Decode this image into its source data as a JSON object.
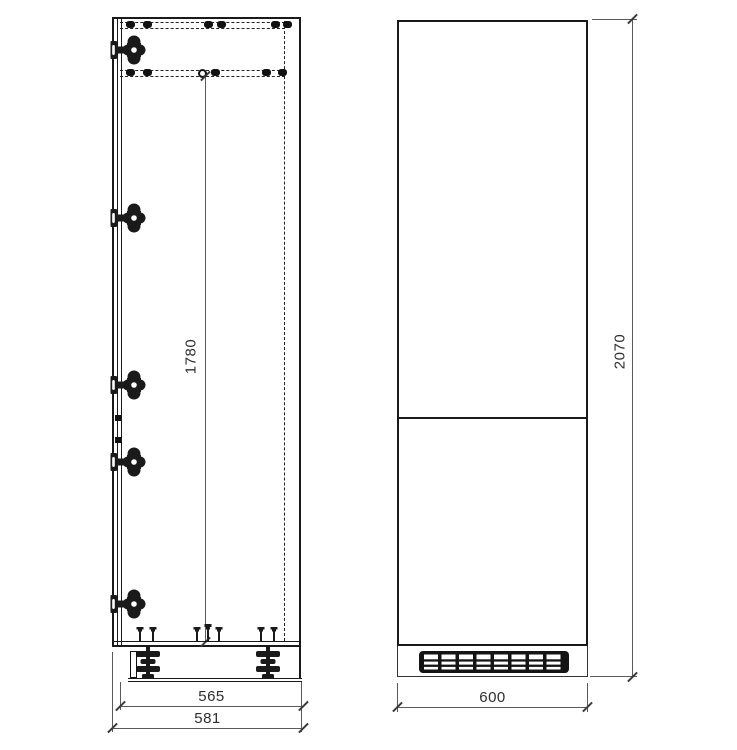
{
  "drawing": {
    "side_view": {
      "dimensions": {
        "interior_height": "1780",
        "carcass_depth": "565",
        "overall_depth": "581"
      }
    },
    "front_view": {
      "dimensions": {
        "width": "600",
        "overall_height": "2070"
      }
    }
  },
  "icons": {
    "hinge": "concealed-cup-hinge",
    "leg": "adjustable-plinth-foot",
    "screw": "fixing-screw",
    "grille": "ventilation-grille"
  },
  "colors": {
    "background": "#ffffff",
    "outline": "#1a1a1a",
    "dimension_line": "#5a5a5a",
    "dimension_text": "#2e2e2e"
  }
}
